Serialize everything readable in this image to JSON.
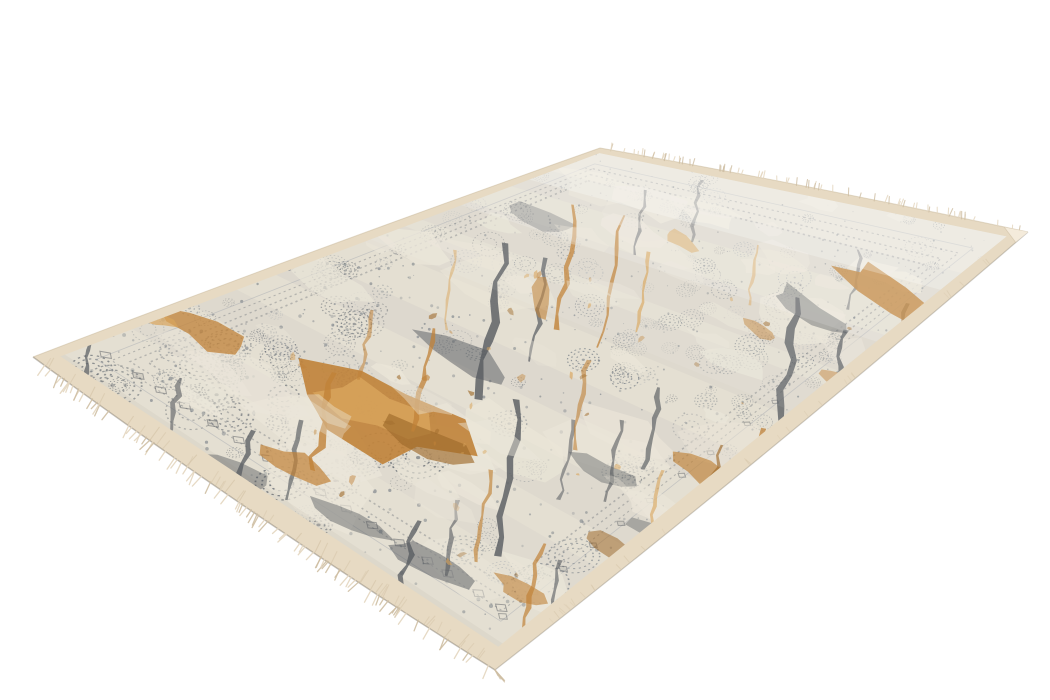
{
  "scene": {
    "background_color": "#ffffff",
    "subject": "Distressed vintage-style rectangular area rug in ivory, grey-blue and burnt orange, photographed at an angle on a plain white background",
    "width": 1050,
    "height": 700
  },
  "rug": {
    "corners": {
      "top": [
        600,
        148
      ],
      "right": [
        1028,
        232
      ],
      "bottom": [
        495,
        670
      ],
      "left": [
        33,
        357
      ]
    },
    "edge_bows": {
      "far": 2,
      "right": 4,
      "near": 5,
      "left": 2
    },
    "insets": {
      "far": 0.016,
      "near": 0.032,
      "left": 0.02,
      "right": 0.03
    },
    "colors": {
      "selvage": "#e7dac3",
      "selvage_shade": "#d2c1a4",
      "selvage_hi": "#f4ecdc",
      "field": "#e4dfd2",
      "wash": "#ebe6d9",
      "stipple": "#7f868c",
      "stipple_light": "#a7acb1",
      "stipple_dark": "#666c73",
      "slate": "#565a5f",
      "orange_mid": "#c08238",
      "orange_light": "#d9a55c",
      "orange_dark": "#9e6a2b",
      "fringe": "#e4d6bf",
      "fringe_shade": "#cfbfa4",
      "edge_line": "#6e6759",
      "rim": "#c7b79a",
      "band": "#979da3",
      "white": "#ffffff"
    },
    "pattern": {
      "seed": 11,
      "speckle_count": 520,
      "rosette_count": 140,
      "wash_count": 55,
      "post_wash_count": 14,
      "band_count": 6,
      "flick_count": 40,
      "clusters": [
        {
          "w": [
            0.55,
            0.92
          ],
          "v": [
            0.15,
            0.5
          ],
          "n": 18,
          "tone": "stipple"
        },
        {
          "w": [
            0.02,
            0.3
          ],
          "v": [
            0.5,
            0.85
          ],
          "n": 14,
          "tone": "stipple_dark"
        },
        {
          "w": [
            0.1,
            0.6
          ],
          "v": [
            0.68,
            0.97
          ],
          "n": 26,
          "tone": "stipple_dark"
        }
      ],
      "orange_blobs": [
        [
          385,
          415,
          88,
          40,
          24,
          "mid",
          0.9
        ],
        [
          378,
          410,
          55,
          24,
          24,
          "light",
          0.8
        ],
        [
          428,
          440,
          40,
          16,
          26,
          "dark",
          0.65
        ],
        [
          205,
          332,
          44,
          14,
          22,
          "mid",
          0.75
        ],
        [
          292,
          464,
          34,
          13,
          24,
          "mid",
          0.7
        ],
        [
          890,
          295,
          64,
          17,
          32,
          "mid",
          0.85
        ],
        [
          948,
          326,
          36,
          12,
          33,
          "light",
          0.8
        ],
        [
          958,
          318,
          26,
          9,
          32,
          "dark",
          0.5
        ],
        [
          540,
          300,
          20,
          9,
          95,
          "mid",
          0.6
        ],
        [
          700,
          470,
          30,
          12,
          26,
          "mid",
          0.65
        ],
        [
          610,
          545,
          26,
          10,
          24,
          "dark",
          0.55
        ],
        [
          155,
          318,
          22,
          8,
          22,
          "light",
          0.7
        ],
        [
          520,
          590,
          30,
          11,
          26,
          "mid",
          0.6
        ],
        [
          680,
          240,
          18,
          7,
          30,
          "light",
          0.55
        ],
        [
          760,
          330,
          22,
          8,
          28,
          "mid",
          0.5
        ],
        [
          835,
          380,
          20,
          8,
          30,
          "mid",
          0.5
        ],
        [
          905,
          430,
          24,
          9,
          30,
          "dark",
          0.45
        ],
        [
          620,
          640,
          30,
          10,
          28,
          "mid",
          0.5
        ]
      ],
      "orange_streaks": [
        [
          575,
          205,
          558,
          330,
          6,
          "mid",
          0.8
        ],
        [
          622,
          215,
          600,
          348,
          5,
          "mid",
          0.75
        ],
        [
          650,
          252,
          636,
          332,
          4,
          "light",
          0.7
        ],
        [
          762,
          428,
          745,
          516,
          7,
          "mid",
          0.75
        ],
        [
          722,
          445,
          702,
          532,
          5,
          "dark",
          0.65
        ],
        [
          543,
          543,
          521,
          628,
          6,
          "mid",
          0.7
        ],
        [
          492,
          470,
          476,
          562,
          5,
          "mid",
          0.65
        ],
        [
          662,
          470,
          647,
          542,
          4,
          "light",
          0.6
        ],
        [
          336,
          373,
          311,
          470,
          9,
          "mid",
          0.8
        ],
        [
          432,
          328,
          416,
          432,
          6,
          "mid",
          0.75
        ],
        [
          906,
          303,
          892,
          382,
          5,
          "dark",
          0.55
        ],
        [
          978,
          298,
          960,
          360,
          4,
          "mid",
          0.6
        ],
        [
          455,
          250,
          445,
          330,
          4,
          "light",
          0.5
        ],
        [
          372,
          310,
          360,
          380,
          5,
          "mid",
          0.55
        ],
        [
          588,
          360,
          574,
          450,
          5,
          "mid",
          0.6
        ],
        [
          758,
          245,
          748,
          305,
          4,
          "light",
          0.5
        ]
      ],
      "slate_streaks": [
        [
          505,
          243,
          481,
          400,
          9,
          0.8
        ],
        [
          520,
          400,
          496,
          556,
          8,
          0.8
        ],
        [
          547,
          258,
          532,
          362,
          5,
          0.7
        ],
        [
          800,
          298,
          779,
          421,
          9,
          0.75
        ],
        [
          846,
          330,
          831,
          402,
          6,
          0.7
        ],
        [
          252,
          430,
          226,
          521,
          8,
          0.75
        ],
        [
          301,
          420,
          286,
          500,
          5,
          0.65
        ],
        [
          416,
          520,
          396,
          610,
          7,
          0.75
        ],
        [
          456,
          500,
          446,
          576,
          5,
          0.6
        ],
        [
          96,
          330,
          81,
          386,
          6,
          0.7
        ],
        [
          662,
          388,
          646,
          470,
          6,
          0.65
        ],
        [
          701,
          180,
          691,
          242,
          4,
          0.45
        ],
        [
          912,
          340,
          896,
          421,
          6,
          0.6
        ],
        [
          621,
          420,
          606,
          502,
          5,
          0.6
        ],
        [
          181,
          378,
          166,
          446,
          6,
          0.6
        ],
        [
          575,
          420,
          560,
          500,
          5,
          0.55
        ],
        [
          645,
          190,
          635,
          255,
          4,
          0.5
        ],
        [
          860,
          250,
          850,
          310,
          4,
          0.5
        ],
        [
          740,
          520,
          725,
          585,
          5,
          0.55
        ],
        [
          560,
          560,
          545,
          640,
          5,
          0.6
        ]
      ],
      "slate_blobs": [
        [
          470,
          362,
          55,
          14,
          24,
          0.5
        ],
        [
          810,
          312,
          55,
          13,
          30,
          0.45
        ],
        [
          350,
          520,
          45,
          13,
          25,
          0.45
        ],
        [
          600,
          470,
          40,
          12,
          24,
          0.4
        ],
        [
          890,
          390,
          40,
          11,
          31,
          0.4
        ],
        [
          230,
          470,
          40,
          12,
          23,
          0.45
        ],
        [
          430,
          560,
          50,
          13,
          25,
          0.5
        ],
        [
          670,
          540,
          40,
          11,
          25,
          0.4
        ],
        [
          540,
          220,
          40,
          10,
          20,
          0.35
        ],
        [
          760,
          560,
          35,
          10,
          27,
          0.4
        ]
      ]
    },
    "border": {
      "dotted_insets": [
        0.05,
        0.068,
        0.086
      ],
      "solid_inset": 0.035,
      "diamond_row_v": 0.915,
      "diamond_count": 16,
      "right_row_w": 0.93,
      "right_diamond_count": 10
    },
    "fringe": {
      "near_count": 85,
      "near_len": [
        7,
        14
      ],
      "far_count": 70,
      "far_len": [
        3.5,
        7.5
      ]
    }
  }
}
